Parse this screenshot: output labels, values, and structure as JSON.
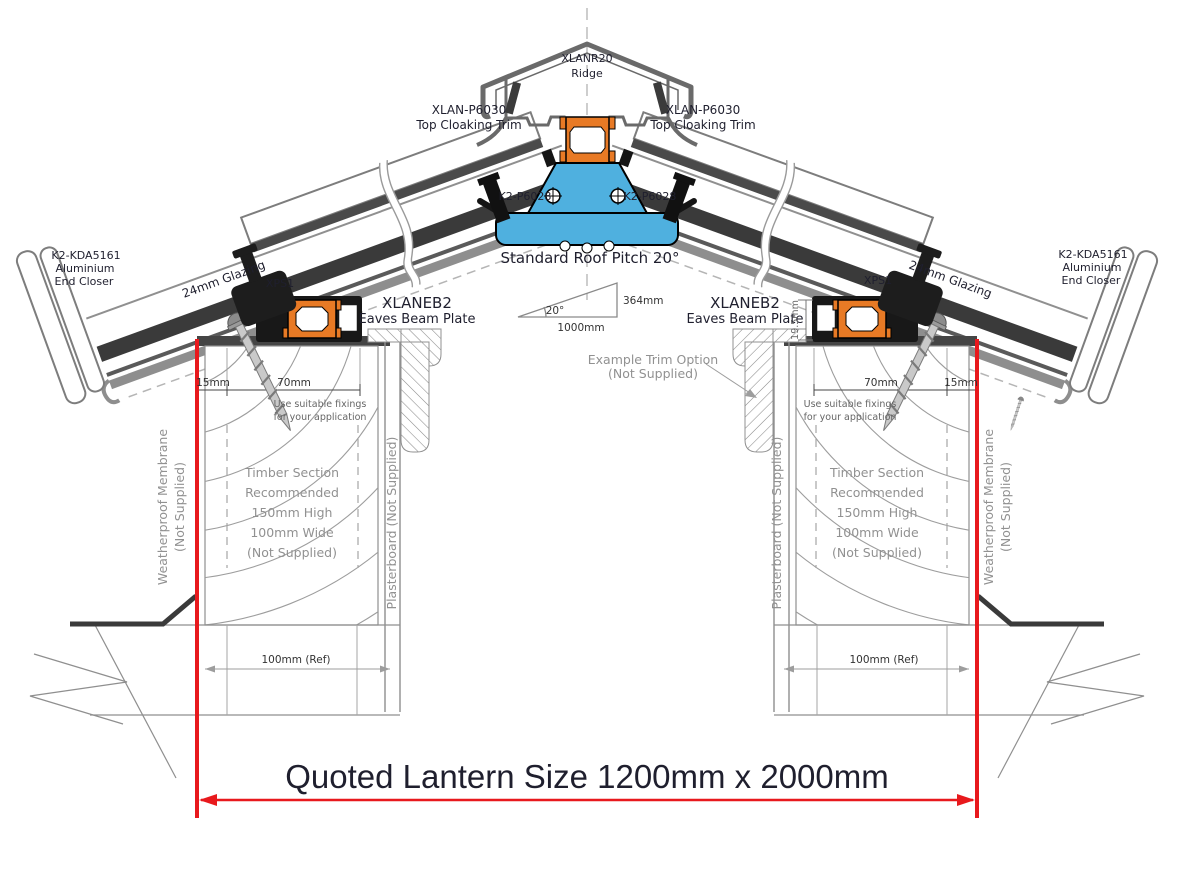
{
  "drawing": {
    "ridge": {
      "code": "XLANR20",
      "name": "Ridge"
    },
    "cloaking_trim": {
      "code": "XLAN-P6030",
      "name": "Top Cloaking Trim"
    },
    "ridge_bolt": {
      "code": "K2-P6028"
    },
    "pitch_note": "Standard Roof Pitch 20°",
    "pitch_triangle": {
      "angle": "20°",
      "base": "1000mm",
      "rise": "364mm"
    },
    "end_closer": {
      "code": "K2-KDA5161",
      "line2": "Aluminium",
      "line3": "End Closer"
    },
    "glazing": "24mm Glazing",
    "xps": "XPS1",
    "eaves_beam": {
      "code": "XLANEB2",
      "name": "Eaves Beam Plate",
      "height_dim": "19.5mm"
    },
    "trim_option": {
      "line1": "Example  Trim Option",
      "line2": "(Not Supplied)"
    },
    "dims": {
      "d15": "15mm",
      "d70": "70mm",
      "ref100": "100mm (Ref)"
    },
    "fixings_note": {
      "line1": "Use suitable fixings",
      "line2": "for your application"
    },
    "timber_note": {
      "line1": "Timber Section",
      "line2": "Recommended",
      "line3": "150mm High",
      "line4": "100mm Wide",
      "line5": "(Not Supplied)"
    },
    "membrane_label": {
      "line1": "Weatherproof Membrane",
      "line2": "(Not Supplied)"
    },
    "plasterboard_label": "Plasterboard (Not Supplied)",
    "quote_text": "Quoted Lantern Size 1200mm x 2000mm",
    "colors": {
      "accent_red": "#e8191d",
      "profile_orange": "#e87a25",
      "thermal_blue": "#4fb0df",
      "dark_metal": "#3a3a3a",
      "aluminium_gray": "#8f8f8f"
    }
  }
}
